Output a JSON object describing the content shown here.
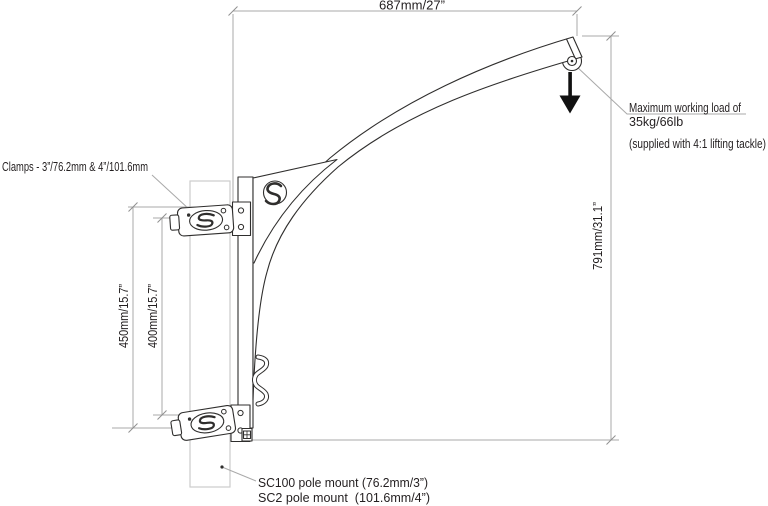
{
  "dims": {
    "top": "687mm/27”",
    "right": "791mm/31.1”",
    "left_outer": "450mm/15.7”",
    "left_inner": "400mm/15.7”"
  },
  "notes": {
    "clamps": "Clamps - 3”/76.2mm & 4”/101.6mm",
    "max_load_1": "Maximum working load of",
    "max_load_2": "35kg/66lb",
    "supplied": "(supplied with 4:1 lifting tackle)",
    "mount_1": "SC100 pole mount (76.2mm/3”)",
    "mount_2": "SC2 pole mount  (101.6mm/4”)"
  },
  "icons": {
    "brand_logo": "s-logo-icon",
    "load_arrow": "down-arrow-icon",
    "pulley": "pulley-icon",
    "rope_cleat": "cleat-hook-icon"
  },
  "colors": {
    "outline": "#2f2e2d",
    "dimension_lines": "#a9a9a9",
    "pole": "#cccccc",
    "text": "#231f20",
    "arrow": "#111111",
    "background": "#ffffff"
  }
}
